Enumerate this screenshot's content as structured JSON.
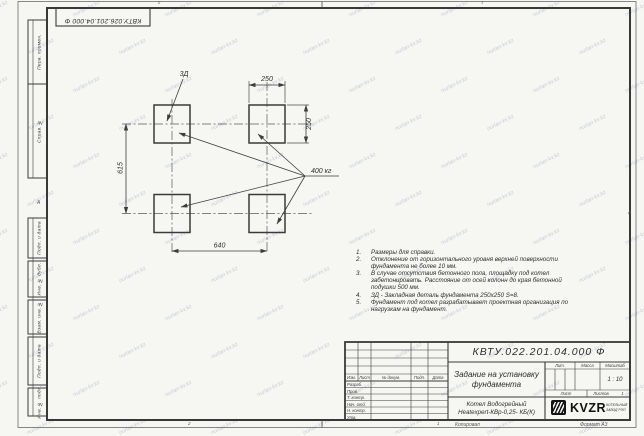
{
  "stamp_top": "КВТУ.026.201.04.000 Ф",
  "watermark_text": "nurlan-kv.kz",
  "margin_boxes": [
    "Перв. примен.",
    "Справ. №",
    "Подп. и дата",
    "Инв. № дубл.",
    "Взам. инв. №",
    "Подп. и дата",
    "Инв. № подл."
  ],
  "zone_markers": {
    "left_letter": "А",
    "right_letter": "А",
    "top_left_num": "2",
    "top_right_num": "1",
    "bottom_left_num": "2",
    "bottom_right_num": "1"
  },
  "drawing": {
    "embed_label": "3Д",
    "load_label": "400 кг",
    "dim_top": "250",
    "dim_right": "250",
    "dim_left": "615",
    "dim_bottom": "640"
  },
  "notes": [
    {
      "num": "1.",
      "text": "Размеры для справки."
    },
    {
      "num": "2.",
      "text": "Отклонение от горизонтального уровня верхней поверхности фундамента не более 10 мм."
    },
    {
      "num": "3.",
      "text": "В случае отсутствия бетонного пола, площадку под котел забетонировать. Расстояние от осей колонн до края бетонной подушки 500 мм."
    },
    {
      "num": "4.",
      "text": "ЗД - Закладная деталь фундамента 250х250 S=8."
    },
    {
      "num": "5.",
      "text": "Фундамент под котел разрабатывает проектная организация по нагрузкам на фундамент."
    }
  ],
  "title_block": {
    "doc_number": "КВТУ.022.201.04.000 Ф",
    "title_line1": "Задание на установку",
    "title_line2": "фундамента",
    "product_line1": "Котел Водогрейный",
    "product_line2": "Heatexpert-КВр-0,25- КБ(К)",
    "header_cols": [
      "Изм.",
      "Лист",
      "№ докум.",
      "Подп.",
      "Дата"
    ],
    "sign_rows": [
      "Разраб.",
      "Пров.",
      "Т. контр.",
      "Нач. отд.",
      "Н. контр.",
      "Утв."
    ],
    "lit_label": "Лит.",
    "mass_label": "Масса",
    "scale_label": "Масштаб",
    "scale_value": "1 : 10",
    "sheet_label": "Лист",
    "sheets_label": "Листов",
    "sheets_value": "1",
    "logo_text": "KVZR",
    "logo_sub1": "КОТЕЛЬНЫЙ",
    "logo_sub2": "ЗАВОД РЭП",
    "copied_label": "Копировал",
    "format_label": "Формат А3"
  }
}
